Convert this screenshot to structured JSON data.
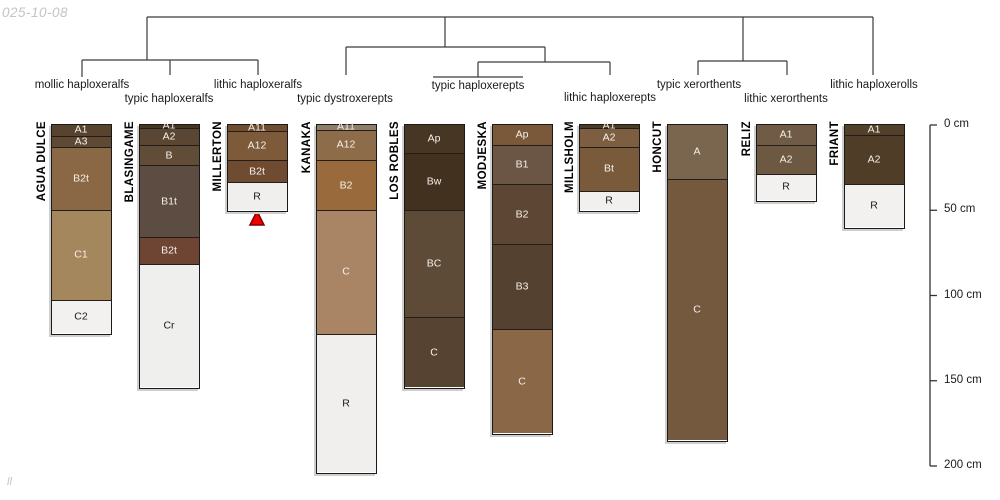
{
  "figure": {
    "watermark_top": "025-10-08",
    "watermark_bottom": "ll"
  },
  "colors": {
    "background": "#ffffff",
    "tree_line": "#3a3a3a",
    "axis_line": "#333333",
    "label_text": "#1a1a1a",
    "horizon_border": "#221d16",
    "light_text": "#f5f0e8",
    "dark_text": "#1a1a1a",
    "watermark": "#c4c4c4",
    "triangle_fill": "#ee0000",
    "triangle_stroke": "#7a0000"
  },
  "chart_data": {
    "type": "soil-profile-columns-with-dendrogram",
    "depth_axis": {
      "unit": "cm",
      "ticks": [
        0,
        50,
        100,
        150,
        200
      ],
      "labels": [
        "0 cm",
        "50 cm",
        "100 cm",
        "150 cm",
        "200 cm"
      ],
      "range": [
        0,
        200
      ]
    },
    "subgroups": [
      {
        "label": "mollic haploxeralfs",
        "cx": 82,
        "label_y": 90
      },
      {
        "label": "typic haploxeralfs",
        "cx": 169,
        "label_y": 104
      },
      {
        "label": "lithic haploxeralfs",
        "cx": 258,
        "label_y": 90
      },
      {
        "label": "typic dystroxerepts",
        "cx": 345,
        "label_y": 104
      },
      {
        "label": "typic haploxerepts",
        "cx": 478,
        "label_y": 91
      },
      {
        "label": "lithic haploxerepts",
        "cx": 610,
        "label_y": 103
      },
      {
        "label": "typic xerorthents",
        "cx": 699,
        "label_y": 90
      },
      {
        "label": "lithic xerorthents",
        "cx": 786,
        "label_y": 104
      },
      {
        "label": "lithic haploxerolls",
        "cx": 874,
        "label_y": 90
      }
    ],
    "tree_segments": [
      [
        147,
        17,
        873,
        17
      ],
      [
        147,
        17,
        147,
        60
      ],
      [
        445,
        17,
        445,
        47
      ],
      [
        743,
        17,
        743,
        61
      ],
      [
        873,
        17,
        873,
        75
      ],
      [
        82,
        60,
        258,
        60
      ],
      [
        82,
        60,
        82,
        77
      ],
      [
        170,
        60,
        170,
        75
      ],
      [
        258,
        60,
        258,
        75
      ],
      [
        346,
        47,
        545,
        47
      ],
      [
        346,
        47,
        346,
        75
      ],
      [
        545,
        47,
        545,
        62
      ],
      [
        478,
        62,
        610,
        62
      ],
      [
        478,
        62,
        478,
        77
      ],
      [
        610,
        62,
        610,
        75
      ],
      [
        433,
        77,
        523,
        77
      ],
      [
        698,
        61,
        787,
        61
      ],
      [
        698,
        61,
        698,
        75
      ],
      [
        787,
        61,
        787,
        75
      ]
    ],
    "columns": [
      {
        "name": "AGUA DULCE",
        "subgroup": "mollic haploxeralfs",
        "x": 52,
        "horizons": [
          {
            "label": "A1",
            "from_cm": 0,
            "to_cm": 7,
            "color": "#58432f"
          },
          {
            "label": "A3",
            "from_cm": 7,
            "to_cm": 13,
            "color": "#5e4935"
          },
          {
            "label": "B2t",
            "from_cm": 13,
            "to_cm": 50,
            "color": "#8a6845"
          },
          {
            "label": "C1",
            "from_cm": 50,
            "to_cm": 103,
            "color": "#a4875c"
          },
          {
            "label": "C2",
            "from_cm": 103,
            "to_cm": 122,
            "color": "#f2f1ef"
          }
        ]
      },
      {
        "name": "BLASINGAME",
        "subgroup": "typic haploxeralfs",
        "x": 140,
        "horizons": [
          {
            "label": "A1",
            "from_cm": 0,
            "to_cm": 2,
            "color": "#463522"
          },
          {
            "label": "A2",
            "from_cm": 2,
            "to_cm": 12,
            "color": "#5b4633"
          },
          {
            "label": "B",
            "from_cm": 12,
            "to_cm": 24,
            "color": "#614c38"
          },
          {
            "label": "B1t",
            "from_cm": 24,
            "to_cm": 66,
            "color": "#5d4c41"
          },
          {
            "label": "B2t",
            "from_cm": 66,
            "to_cm": 82,
            "color": "#6e4433"
          },
          {
            "label": "Cr",
            "from_cm": 82,
            "to_cm": 154,
            "color": "#efefed"
          }
        ]
      },
      {
        "name": "MILLERTON",
        "subgroup": "lithic haploxeralfs",
        "x": 228,
        "horizons": [
          {
            "label": "A11",
            "from_cm": 0,
            "to_cm": 4,
            "color": "#6f4d2e"
          },
          {
            "label": "A12",
            "from_cm": 4,
            "to_cm": 21,
            "color": "#7d5a39"
          },
          {
            "label": "B2t",
            "from_cm": 21,
            "to_cm": 34,
            "color": "#6f4b31"
          },
          {
            "label": "R",
            "from_cm": 34,
            "to_cm": 50,
            "color": "#f0efed"
          }
        ]
      },
      {
        "name": "KANAKA",
        "subgroup": "typic dystroxerepts",
        "x": 317,
        "horizons": [
          {
            "label": "A11",
            "from_cm": 0,
            "to_cm": 3,
            "color": "#8d7d6a"
          },
          {
            "label": "A12",
            "from_cm": 3,
            "to_cm": 21,
            "color": "#8c6c49"
          },
          {
            "label": "B2",
            "from_cm": 21,
            "to_cm": 50,
            "color": "#996b3c"
          },
          {
            "label": "C",
            "from_cm": 50,
            "to_cm": 123,
            "color": "#a98565"
          },
          {
            "label": "R",
            "from_cm": 123,
            "to_cm": 204,
            "color": "#f0efee"
          }
        ]
      },
      {
        "name": "LOS ROBLES",
        "subgroup": "typic haploxerepts",
        "x": 405,
        "horizons": [
          {
            "label": "Ap",
            "from_cm": 0,
            "to_cm": 17,
            "color": "#473624"
          },
          {
            "label": "Bw",
            "from_cm": 17,
            "to_cm": 50,
            "color": "#42311f"
          },
          {
            "label": "BC",
            "from_cm": 50,
            "to_cm": 113,
            "color": "#5d4a37"
          },
          {
            "label": "C",
            "from_cm": 113,
            "to_cm": 154,
            "color": "#574331"
          }
        ]
      },
      {
        "name": "MODJESKA",
        "subgroup": "typic haploxerepts",
        "x": 493,
        "horizons": [
          {
            "label": "Ap",
            "from_cm": 0,
            "to_cm": 12,
            "color": "#7a583a"
          },
          {
            "label": "B1",
            "from_cm": 12,
            "to_cm": 35,
            "color": "#6b5645"
          },
          {
            "label": "B2",
            "from_cm": 35,
            "to_cm": 70,
            "color": "#5e4634"
          },
          {
            "label": "B3",
            "from_cm": 70,
            "to_cm": 120,
            "color": "#544130"
          },
          {
            "label": "C",
            "from_cm": 120,
            "to_cm": 181,
            "color": "#8a6746"
          }
        ]
      },
      {
        "name": "MILLSHOLM",
        "subgroup": "lithic haploxerepts",
        "x": 580,
        "horizons": [
          {
            "label": "A1",
            "from_cm": 0,
            "to_cm": 2,
            "color": "#4a3a26"
          },
          {
            "label": "A2",
            "from_cm": 2,
            "to_cm": 13,
            "color": "#7d5e40"
          },
          {
            "label": "Bt",
            "from_cm": 13,
            "to_cm": 39,
            "color": "#795a3b"
          },
          {
            "label": "R",
            "from_cm": 39,
            "to_cm": 50,
            "color": "#f1f0ee"
          }
        ]
      },
      {
        "name": "HONCUT",
        "subgroup": "typic xerorthents",
        "x": 668,
        "horizons": [
          {
            "label": "A",
            "from_cm": 0,
            "to_cm": 32,
            "color": "#7a654e"
          },
          {
            "label": "C",
            "from_cm": 32,
            "to_cm": 185,
            "color": "#75593f"
          }
        ]
      },
      {
        "name": "RELIZ",
        "subgroup": "lithic xerorthents",
        "x": 757,
        "horizons": [
          {
            "label": "A1",
            "from_cm": 0,
            "to_cm": 12,
            "color": "#705c46"
          },
          {
            "label": "A2",
            "from_cm": 12,
            "to_cm": 29,
            "color": "#6d5842"
          },
          {
            "label": "R",
            "from_cm": 29,
            "to_cm": 44,
            "color": "#f2f1ef"
          }
        ]
      },
      {
        "name": "FRIANT",
        "subgroup": "lithic haploxerolls",
        "x": 845,
        "horizons": [
          {
            "label": "A1",
            "from_cm": 0,
            "to_cm": 6,
            "color": "#52402b"
          },
          {
            "label": "A2",
            "from_cm": 6,
            "to_cm": 35,
            "color": "#4f3d28"
          },
          {
            "label": "R",
            "from_cm": 35,
            "to_cm": 60,
            "color": "#f2f1ef"
          }
        ]
      }
    ],
    "marker": {
      "shape": "red-triangle",
      "below_column": "MILLERTON",
      "cx": 257,
      "apex_y": 211,
      "base_y": 225,
      "half_width": 7
    }
  }
}
